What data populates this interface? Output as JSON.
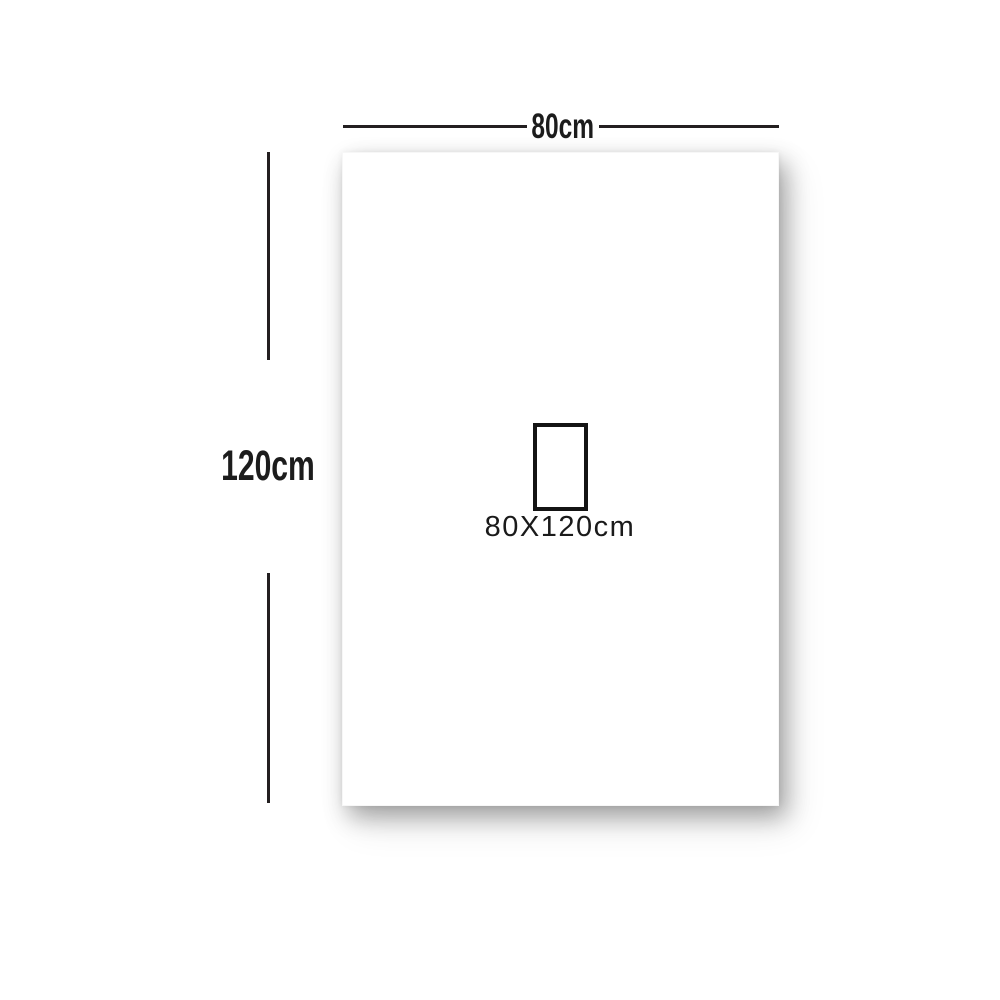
{
  "labels": {
    "width": "80cm",
    "height": "120cm",
    "size": "80X120cm"
  },
  "colors": {
    "line": "#231f20",
    "text": "#1c1c1c",
    "panel_bg": "#ffffff",
    "page_bg": "#ffffff"
  }
}
